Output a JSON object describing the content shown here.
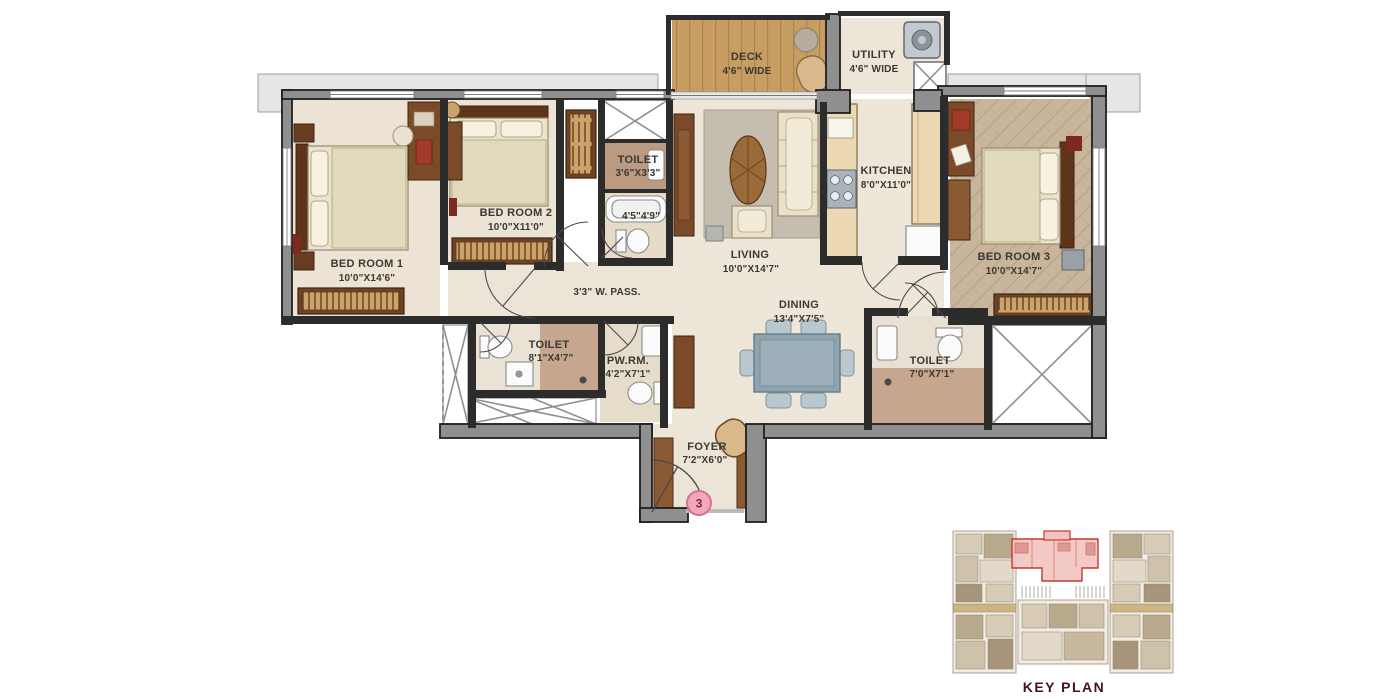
{
  "plan": {
    "bedroom1": {
      "name": "BED ROOM 1",
      "dims": "10'0\"X14'6\""
    },
    "bedroom2": {
      "name": "BED ROOM 2",
      "dims": "10'0\"X11'0\""
    },
    "bedroom3": {
      "name": "BED ROOM 3",
      "dims": "10'0\"X14'7\""
    },
    "living": {
      "name": "LIVING",
      "dims": "10'0\"X14'7\""
    },
    "dining": {
      "name": "DINING",
      "dims": "13'4\"X7'5\""
    },
    "kitchen": {
      "name": "KITCHEN",
      "dims": "8'0\"X11'0\""
    },
    "deck": {
      "name": "DECK",
      "dims": "4'6\" WIDE"
    },
    "utility": {
      "name": "UTILITY",
      "dims": "4'6\" WIDE"
    },
    "toilet_master": {
      "name": "TOILET",
      "dims": "3'6\"X3'3\""
    },
    "bath_master": {
      "dims": "4'5\"4'9\""
    },
    "passage": {
      "name": "3'3\" W. PASS."
    },
    "toilet_common": {
      "name": "TOILET",
      "dims": "8'1\"X4'7\""
    },
    "powder_room": {
      "name": "PW.RM.",
      "dims": "4'2\"X7'1\""
    },
    "toilet_bed3": {
      "name": "TOILET",
      "dims": "7'0\"X7'1\""
    },
    "foyer": {
      "name": "FOYER",
      "dims": "7'2\"X6'0\""
    },
    "unit_number": "3",
    "key_plan_title": "KEY PLAN"
  },
  "colors": {
    "highlight_unit": "#c23b2e",
    "unit_badge": "#f4a7ba",
    "wall": "#2c2c2c",
    "floor": "#ece4d6"
  }
}
